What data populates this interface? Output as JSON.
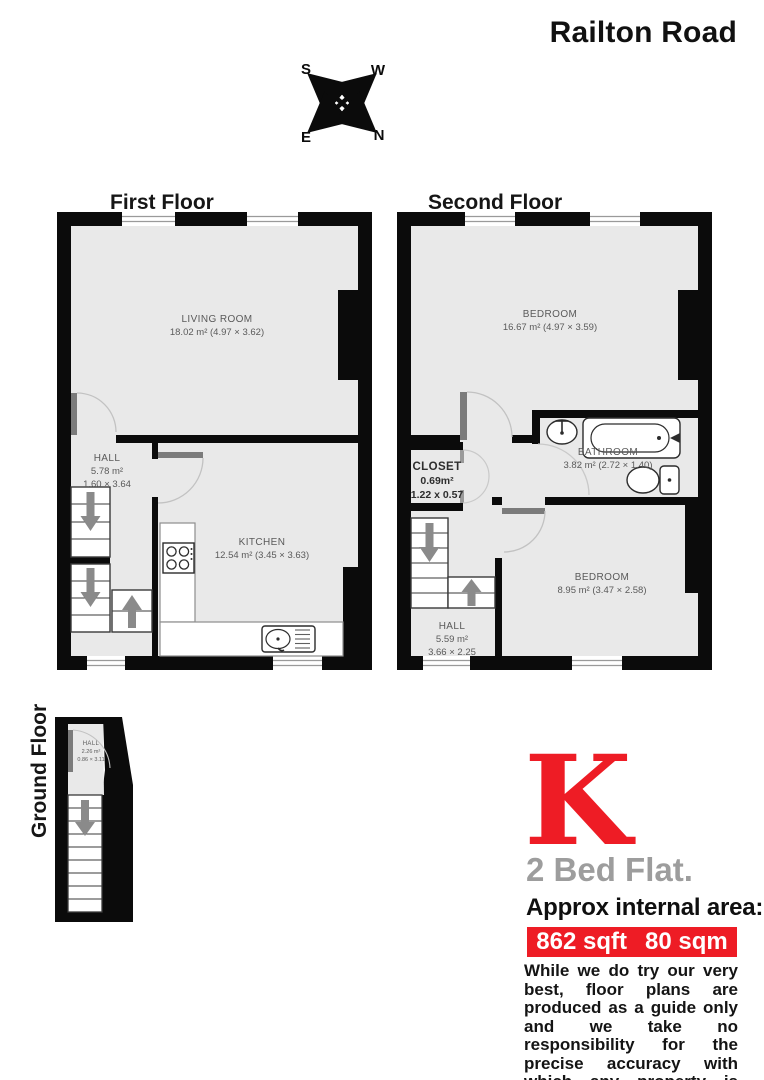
{
  "title": "Railton Road",
  "compass": {
    "s": "S",
    "w": "W",
    "e": "E",
    "n": "N"
  },
  "floors": {
    "first": {
      "label": "First Floor",
      "rooms": {
        "living_room": {
          "name": "LIVING ROOM",
          "area": "18.02 m² (4.97 × 3.62)"
        },
        "hall": {
          "name": "HALL",
          "area": "5.78 m²",
          "dims": "1.60 × 3.64"
        },
        "kitchen": {
          "name": "KITCHEN",
          "area": "12.54 m² (3.45 × 3.63)"
        }
      }
    },
    "second": {
      "label": "Second Floor",
      "rooms": {
        "bedroom1": {
          "name": "BEDROOM",
          "area": "16.67 m² (4.97 × 3.59)"
        },
        "closet": {
          "name": "CLOSET",
          "area": "0.69m²",
          "dims": "1.22 x 0.57"
        },
        "bathroom": {
          "name": "BATHROOM",
          "area": "3.82 m² (2.72 × 1.40)"
        },
        "hall": {
          "name": "HALL",
          "area": "5.59 m²",
          "dims": "3.66 × 2.25"
        },
        "bedroom2": {
          "name": "BEDROOM",
          "area": "8.95 m² (3.47 × 2.58)"
        }
      }
    },
    "ground": {
      "label": "Ground Floor",
      "rooms": {
        "hall": {
          "name": "HALL",
          "area": "2.26 m²",
          "dims": "0.86 × 3.11"
        }
      }
    }
  },
  "branding": {
    "logo_letter": "K",
    "property_type": "2 Bed Flat.",
    "area_heading": "Approx internal area:",
    "area_sqft": "862 sqft",
    "area_sqm": "80 sqm",
    "disclaimer": "While we do try our very best, floor plans are produced as a guide only and we take no responsibility for the precise accuracy with which any property is represented",
    "accent_red": "#ee1c25",
    "wall_black": "#0b0b0b",
    "room_gray": "#e9e9e9"
  }
}
